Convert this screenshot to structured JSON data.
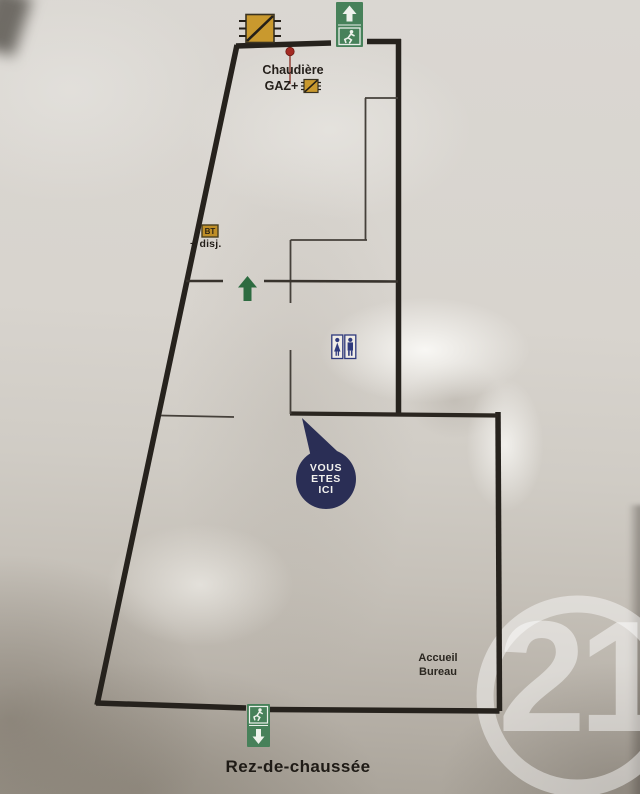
{
  "plan": {
    "floor_label": "Rez-de-chaussée",
    "boiler": {
      "line1": "Chaudière",
      "line2": "GAZ+"
    },
    "electrical": {
      "box": "BT",
      "label": "+ disj."
    },
    "reception": {
      "line1": "Accueil",
      "line2": "Bureau"
    },
    "you_are_here": {
      "line1": "VOUS",
      "line2": "ETES",
      "line3": "ICI"
    }
  },
  "watermark": {
    "text": "21"
  },
  "icons": {
    "top_exit": "exit-up-sign-icon (white up arrow + running man on green)",
    "bottom_exit": "exit-down-sign-icon (running man + white down arrow on green)",
    "toilets": "toilets-icon (woman and man pictograms, navy)",
    "boiler_symbol": "electrical-device-icon (yellow square, black diagonal)",
    "gaz_symbol": "electrical-device-icon (small yellow square, black diagonal)",
    "bt_symbol": "bt-breaker-icon (small yellow box labelled BT)",
    "flow_arrow": "up-arrow-icon (dark green)",
    "pin": "location-pin-icon (red dot with leader line)"
  },
  "colors": {
    "wall": "#26221d",
    "interior_wall": "#45403a",
    "exit_green": "#47815a",
    "arrow_green": "#2d6b40",
    "symbol_yellow": "#c9992e",
    "symbol_border": "#3a3322",
    "toilet_navy": "#2f3a7d",
    "balloon_navy": "#2a2e55",
    "pin_red": "#a42a23",
    "text_dark": "#241f1a",
    "paper": "#d6d2cb",
    "watermark": "#ffffff"
  }
}
